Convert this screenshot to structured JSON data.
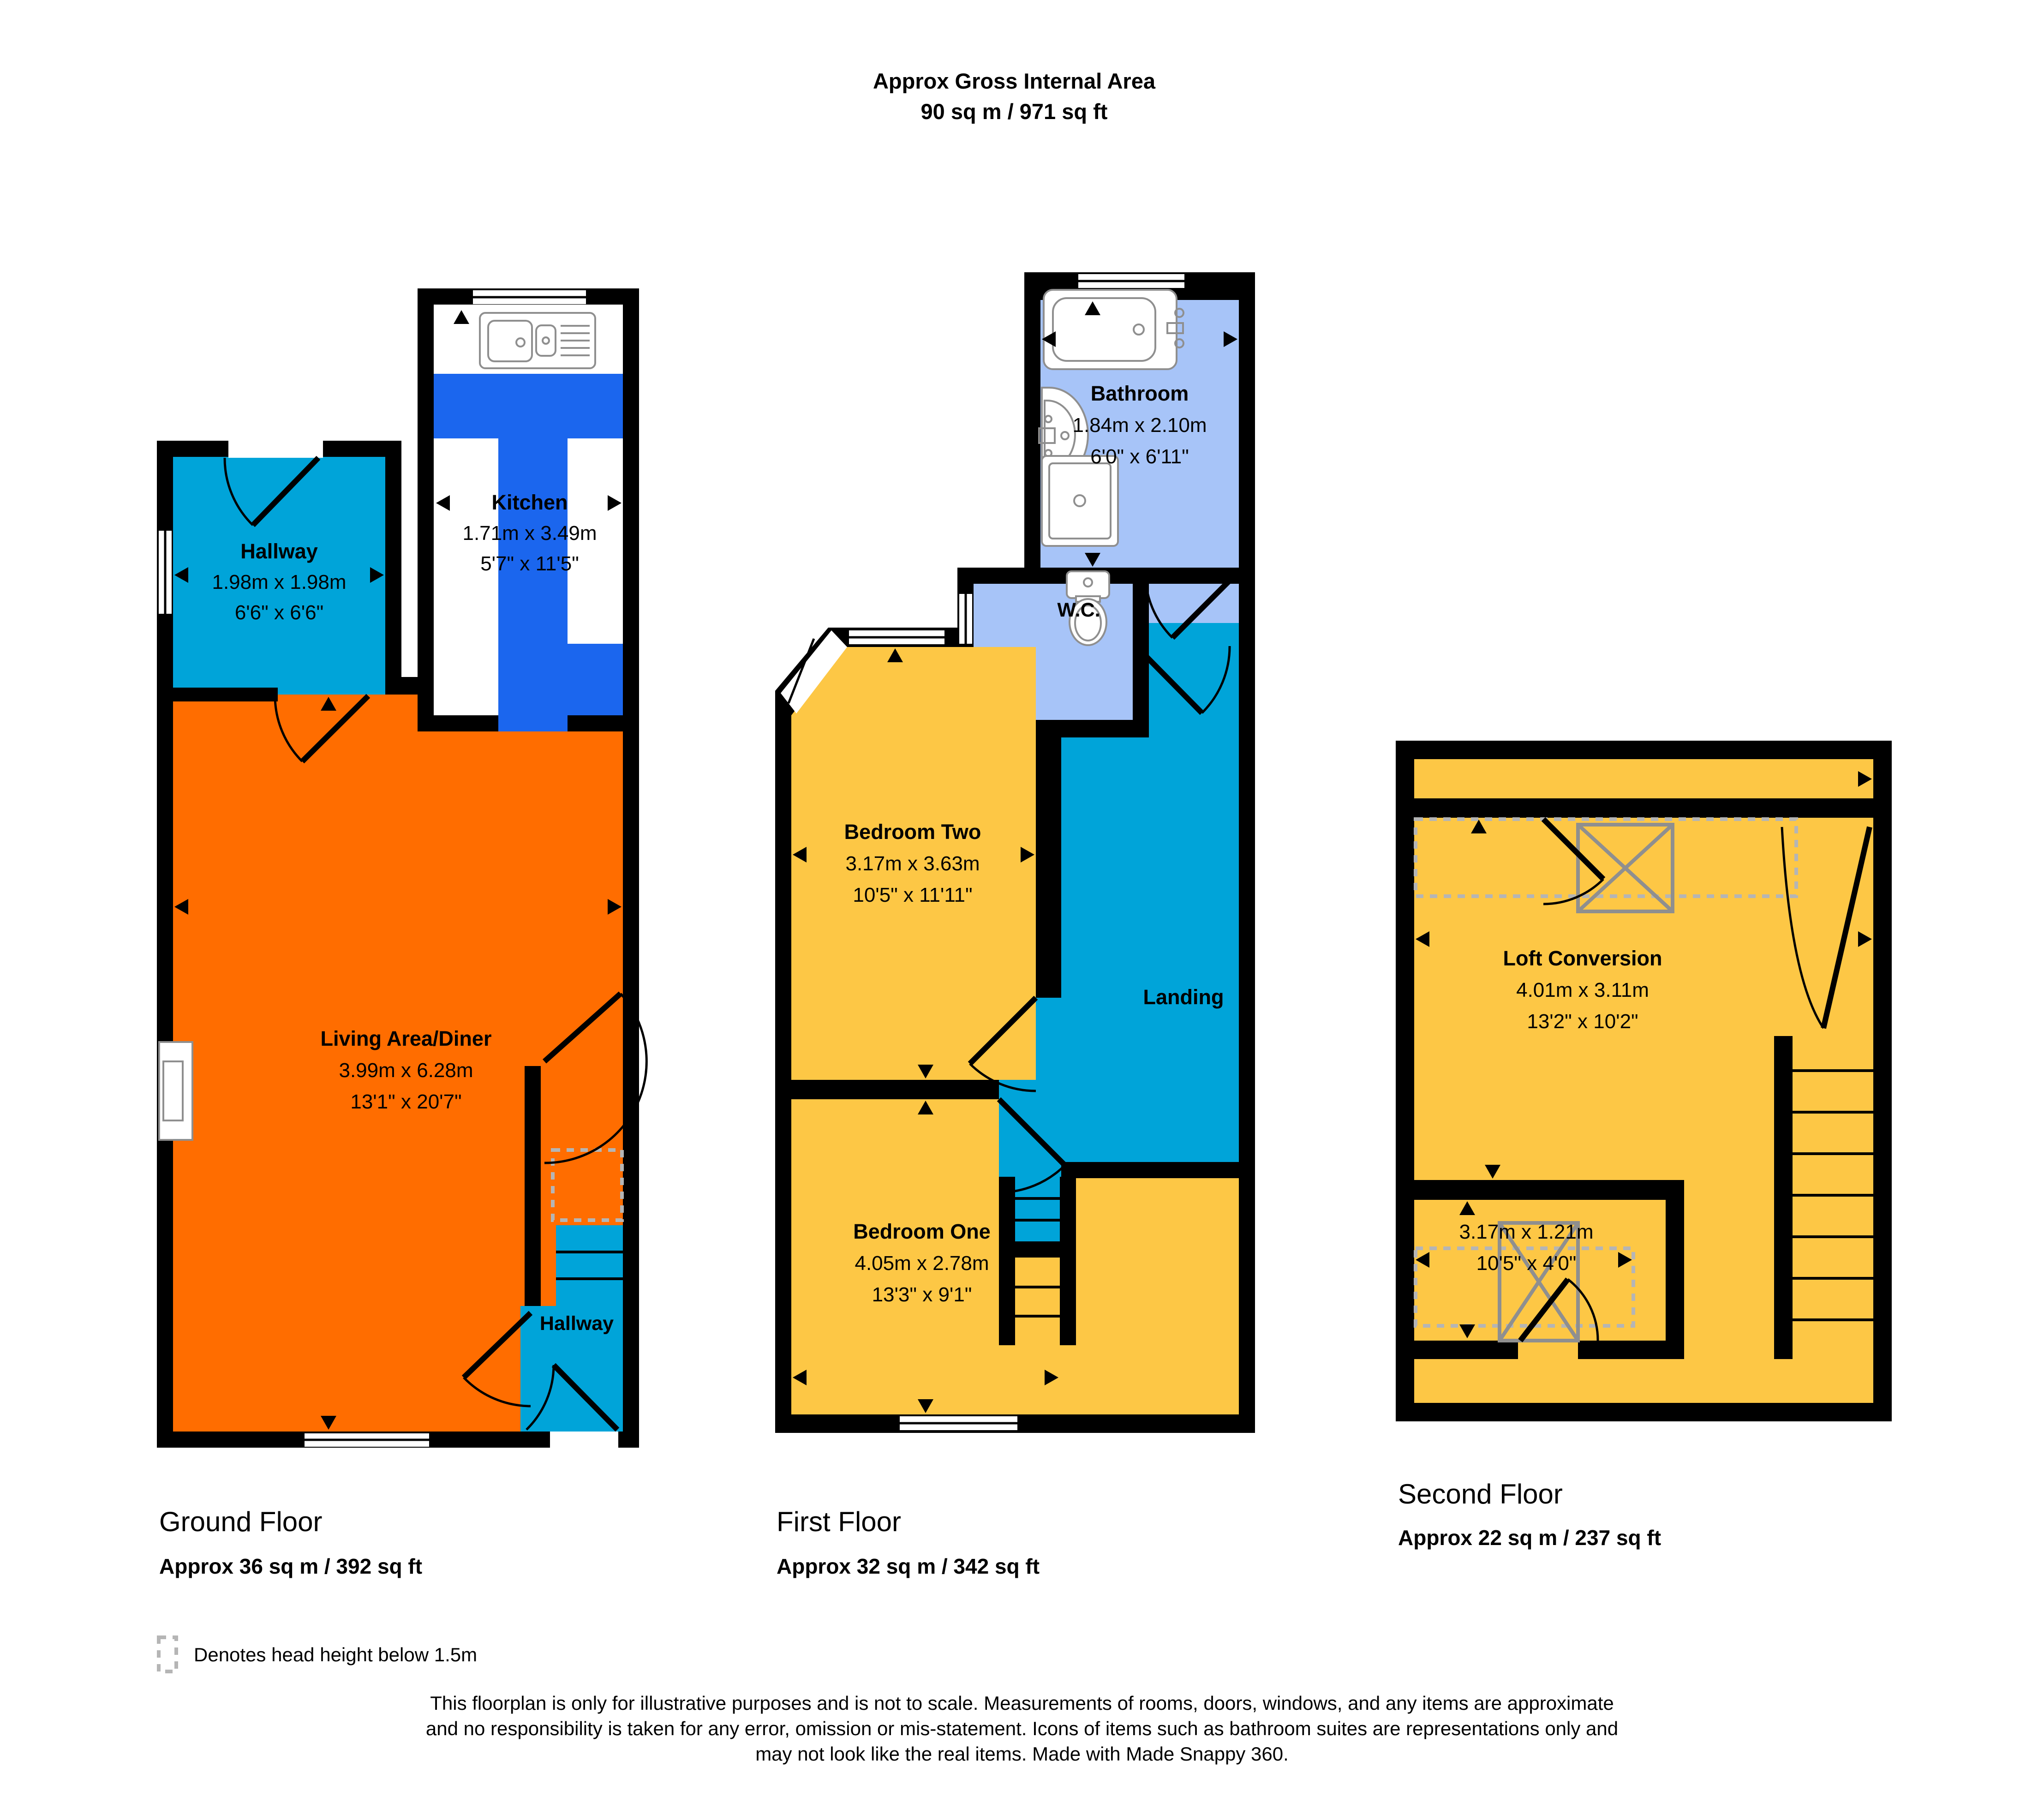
{
  "header": {
    "line1": "Approx Gross Internal Area",
    "line2": "90 sq m / 971 sq ft"
  },
  "floors": {
    "ground": {
      "label": "Ground Floor",
      "area": "Approx 36 sq m / 392 sq ft"
    },
    "first": {
      "label": "First Floor",
      "area": "Approx 32 sq m / 342 sq ft"
    },
    "second": {
      "label": "Second Floor",
      "area": "Approx 22 sq m / 237 sq ft"
    }
  },
  "rooms": {
    "gf_hallway": {
      "name": "Hallway",
      "metric": "1.98m x 1.98m",
      "imperial": "6'6\" x 6'6\""
    },
    "kitchen": {
      "name": "Kitchen",
      "metric": "1.71m x 3.49m",
      "imperial": "5'7\" x 11'5\""
    },
    "living": {
      "name": "Living Area/Diner",
      "metric": "3.99m x 6.28m",
      "imperial": "13'1\" x 20'7\""
    },
    "gf_hallway_rear": {
      "name": "Hallway"
    },
    "bathroom": {
      "name": "Bathroom",
      "metric": "1.84m x 2.10m",
      "imperial": "6'0\" x 6'11\""
    },
    "wc": {
      "name": "W.C."
    },
    "bedroom_two": {
      "name": "Bedroom Two",
      "metric": "3.17m x 3.63m",
      "imperial": "10'5\" x 11'11\""
    },
    "landing": {
      "name": "Landing"
    },
    "bedroom_one": {
      "name": "Bedroom One",
      "metric": "4.05m x 2.78m",
      "imperial": "13'3\" x 9'1\""
    },
    "loft": {
      "name": "Loft Conversion",
      "metric": "4.01m x 3.11m",
      "imperial": "13'2\" x 10'2\""
    },
    "loft_lower": {
      "metric": "3.17m x 1.21m",
      "imperial": "10'5\" x 4'0\""
    }
  },
  "legend": {
    "label": "Denotes head height below 1.5m"
  },
  "disclaimer": {
    "line1": "This floorplan is only for illustrative purposes and is not to scale. Measurements of rooms, doors, windows, and any items are approximate",
    "line2": "and no responsibility is taken for any error, omission or mis-statement. Icons of items such as bathroom suites are representations only and",
    "line3": "may not look like the real items. Made with Made Snappy 360."
  },
  "colors": {
    "orange": "#ff6d00",
    "teal": "#00a4d9",
    "blue": "#1b66ee",
    "lightblue": "#a7c4f8",
    "yellow": "#fdc745",
    "wall": "#000000",
    "fixture": "#8f8f8f",
    "dash": "#b5b5b5"
  }
}
